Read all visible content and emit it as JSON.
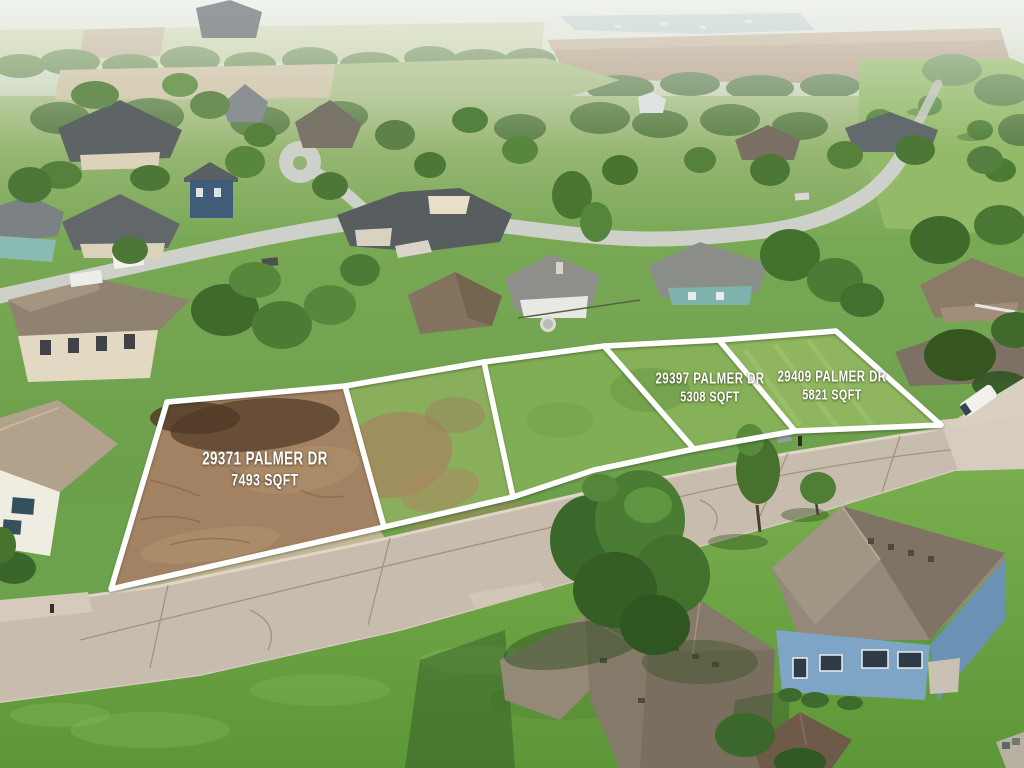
{
  "photo": {
    "kind": "aerial-drone-photo",
    "subject": "suburban neighborhood with five outlined vacant lots for sale"
  },
  "overlay": {
    "boundary_color": "#ffffff",
    "label_color": "#ffffff",
    "lots": [
      {
        "address": "29371 PALMER DR",
        "area": "7493 SQFT"
      },
      {
        "address": "29397 PALMER DR",
        "area": "5308 SQFT"
      },
      {
        "address": "29409 PALMER DR",
        "area": "5821 SQFT"
      }
    ]
  },
  "palette": {
    "haze_sky": "#e9ede8",
    "lake": "#b9c8ce",
    "distant_field_brown": "#b7a28b",
    "lawn_green": "#74a651",
    "lot_grass": "#86b158",
    "dirt_lot": "#a28262",
    "road_concrete": "#c8bcae",
    "roof_charcoal": "#5e6366",
    "roof_taupe": "#8f8271",
    "blue_house_siding": "#7ea4c6",
    "red_car": "#a2293f"
  }
}
